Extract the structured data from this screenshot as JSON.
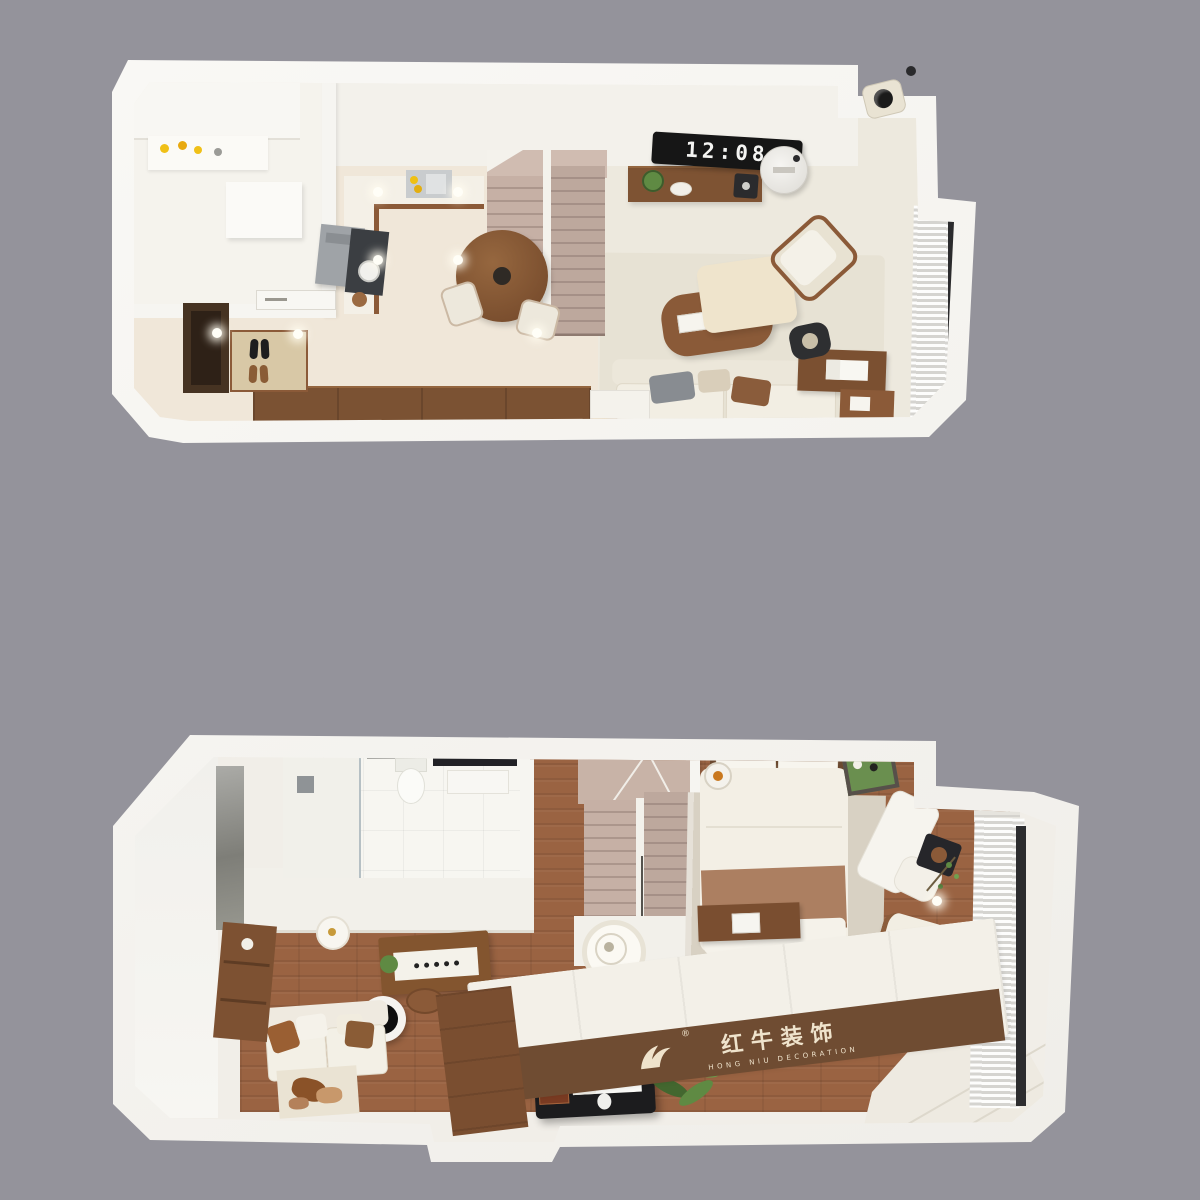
{
  "scene": {
    "background_color": "#94939B",
    "view": "two 3D top-down floor plans of a duplex apartment"
  },
  "upper_floor": {
    "clock_display": "12:08",
    "objects": [
      "utility-room",
      "kitchen-counter",
      "range-hood",
      "cooktop",
      "sink",
      "entry-door",
      "shoe-cabinet",
      "shoe-mat",
      "sideboard",
      "staircase",
      "dining-table",
      "dining-chairs",
      "tv-console",
      "flip-clock",
      "air-purifier",
      "speaker",
      "sofa",
      "side-table-lamp",
      "coffee-table",
      "lounge-chair",
      "desk",
      "desk-chair",
      "curtain-window",
      "security-camera",
      "downlights"
    ]
  },
  "lower_floor": {
    "objects": [
      "bathroom",
      "shower",
      "toilet",
      "vanity-mirror",
      "marble-wall",
      "staircase",
      "pendant-lamp",
      "study-desk",
      "stools",
      "round-tray-table",
      "sofa",
      "area-rug",
      "bookshelf",
      "piano",
      "piano-bench",
      "potted-plant",
      "wall-cabinet",
      "ceiling-lamp",
      "bed",
      "pillows",
      "bed-rug",
      "round-rug",
      "bedside-lamp",
      "bench-desk",
      "chaise",
      "tray-table",
      "armchair",
      "curtain-window",
      "platform-bed",
      "wood-steps",
      "steps"
    ]
  },
  "watermark": {
    "registered_symbol": "®",
    "brand_cn": "红牛装饰",
    "brand_en": "HONG NIU DECORATION",
    "text_color": "#EFE3CC",
    "band_color": "#6F4C32"
  },
  "palette": {
    "background": "#94939B",
    "wall_white": "#F7F6F3",
    "floor_cream": "#F0E7D9",
    "living_floor": "#EDE9DE",
    "rug_beige": "#E7E2D4",
    "walnut": "#8B5A38",
    "walnut_dark": "#6F4B2F",
    "wood_floor": "#9A6342",
    "stair_taupe": "#C2ACA0",
    "clock_bg": "#161616",
    "clock_digits": "#F4F4F2",
    "curtain_glass": "#2B2B2D"
  }
}
